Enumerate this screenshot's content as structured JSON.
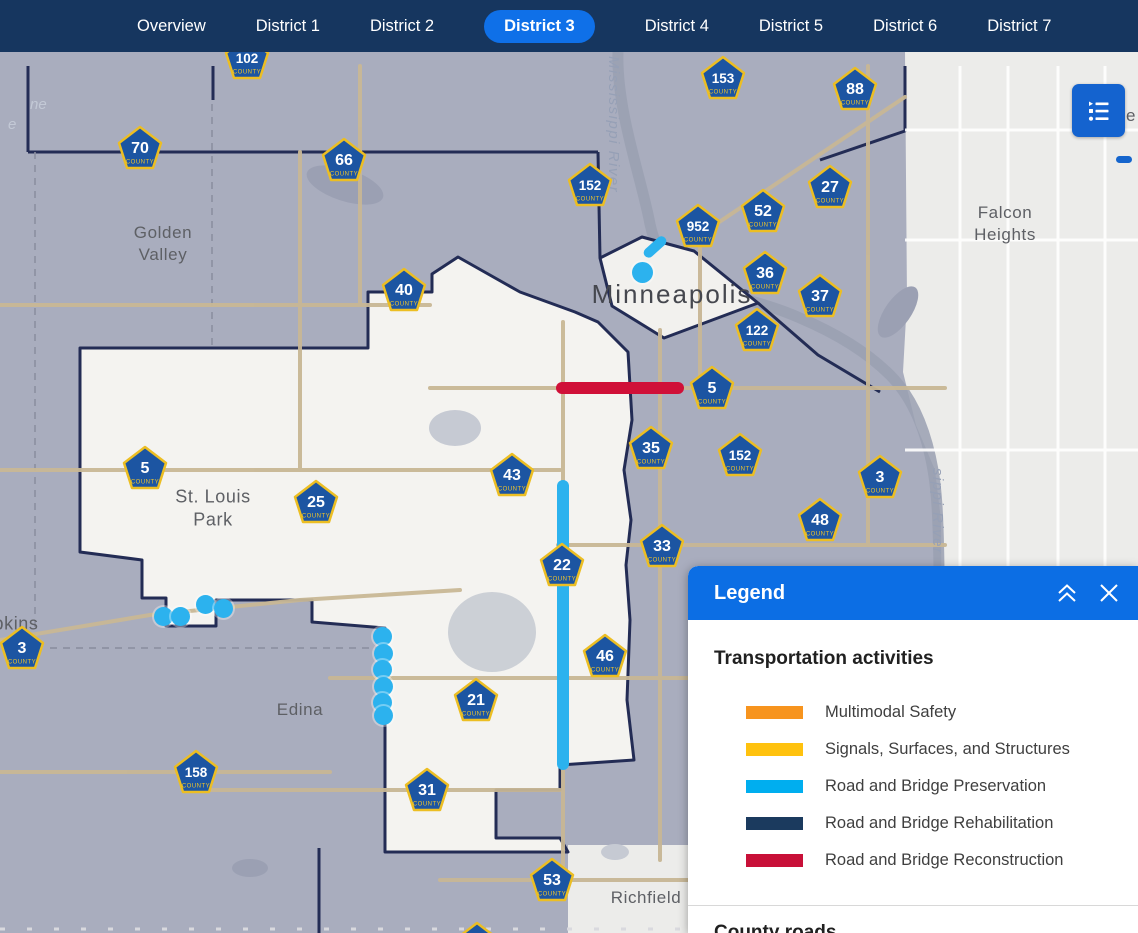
{
  "nav": {
    "tabs": [
      {
        "label": "Overview",
        "active": false
      },
      {
        "label": "District 1",
        "active": false
      },
      {
        "label": "District 2",
        "active": false
      },
      {
        "label": "District 3",
        "active": true
      },
      {
        "label": "District 4",
        "active": false
      },
      {
        "label": "District 5",
        "active": false
      },
      {
        "label": "District 6",
        "active": false
      },
      {
        "label": "District 7",
        "active": false
      }
    ]
  },
  "map": {
    "city_labels": [
      {
        "lines": [
          "Golden",
          "Valley"
        ],
        "x": 163,
        "y": 244,
        "size": 17
      },
      {
        "lines": [
          "Minneapolis"
        ],
        "x": 672,
        "y": 295,
        "size": 26,
        "big": true
      },
      {
        "lines": [
          "Falcon",
          "Heights"
        ],
        "x": 1005,
        "y": 224,
        "size": 17
      },
      {
        "lines": [
          "St. Louis",
          "Park"
        ],
        "x": 213,
        "y": 509,
        "size": 18
      },
      {
        "lines": [
          "pkins"
        ],
        "x": 16,
        "y": 624,
        "size": 18
      },
      {
        "lines": [
          "Edina"
        ],
        "x": 300,
        "y": 710,
        "size": 17
      },
      {
        "lines": [
          "Richfield"
        ],
        "x": 646,
        "y": 898,
        "size": 17
      }
    ],
    "water_labels": [
      {
        "text": "Mississippi River",
        "x": 622,
        "y": 56
      },
      {
        "text": "sippi River",
        "x": 946,
        "y": 468
      }
    ],
    "label_fragments": [
      {
        "text": "ne",
        "x": 30,
        "y": 96,
        "dark": false,
        "size": 15
      },
      {
        "text": "e",
        "x": 8,
        "y": 116,
        "dark": false,
        "size": 15
      },
      {
        "text": "e",
        "x": 1126,
        "y": 106,
        "dark": true,
        "size": 17
      }
    ],
    "shield_sub_label": "COUNTY",
    "shields": [
      {
        "n": "102",
        "x": 247,
        "y": 58
      },
      {
        "n": "70",
        "x": 140,
        "y": 148
      },
      {
        "n": "66",
        "x": 344,
        "y": 160
      },
      {
        "n": "153",
        "x": 723,
        "y": 78
      },
      {
        "n": "88",
        "x": 855,
        "y": 89
      },
      {
        "n": "152",
        "x": 590,
        "y": 185
      },
      {
        "n": "27",
        "x": 830,
        "y": 187
      },
      {
        "n": "52",
        "x": 763,
        "y": 211
      },
      {
        "n": "952",
        "x": 698,
        "y": 226
      },
      {
        "n": "36",
        "x": 765,
        "y": 273
      },
      {
        "n": "40",
        "x": 404,
        "y": 290
      },
      {
        "n": "37",
        "x": 820,
        "y": 296
      },
      {
        "n": "122",
        "x": 757,
        "y": 330
      },
      {
        "n": "5",
        "x": 712,
        "y": 388
      },
      {
        "n": "35",
        "x": 651,
        "y": 448
      },
      {
        "n": "152",
        "x": 740,
        "y": 455
      },
      {
        "n": "5",
        "x": 145,
        "y": 468
      },
      {
        "n": "43",
        "x": 512,
        "y": 475
      },
      {
        "n": "3",
        "x": 880,
        "y": 477
      },
      {
        "n": "25",
        "x": 316,
        "y": 502
      },
      {
        "n": "48",
        "x": 820,
        "y": 520
      },
      {
        "n": "33",
        "x": 662,
        "y": 546
      },
      {
        "n": "22",
        "x": 562,
        "y": 565
      },
      {
        "n": "3",
        "x": 22,
        "y": 648
      },
      {
        "n": "46",
        "x": 605,
        "y": 656
      },
      {
        "n": "21",
        "x": 476,
        "y": 700
      },
      {
        "n": "158",
        "x": 196,
        "y": 772
      },
      {
        "n": "31",
        "x": 427,
        "y": 790
      },
      {
        "n": "53",
        "x": 552,
        "y": 880
      },
      {
        "n": "",
        "x": 477,
        "y": 944
      }
    ],
    "features": {
      "preservation_color": "#2CB2EE",
      "reconstruction_color": "#D01038",
      "red_line": {
        "x": 556,
        "y": 382,
        "w": 128,
        "h": 12
      },
      "blue_line": {
        "x": 557,
        "y": 480,
        "w": 12,
        "h": 290
      },
      "downtown_segment": {
        "x": 645,
        "y": 251,
        "w": 27,
        "h": 10,
        "angle": -42
      },
      "downtown_dot": {
        "x": 642,
        "y": 272,
        "d": 21
      },
      "left_dots": [
        {
          "x": 163,
          "y": 616
        },
        {
          "x": 180,
          "y": 616
        },
        {
          "x": 205,
          "y": 604
        },
        {
          "x": 223,
          "y": 608
        }
      ],
      "edina_dots": [
        {
          "x": 382,
          "y": 636
        },
        {
          "x": 383,
          "y": 653
        },
        {
          "x": 382,
          "y": 669
        },
        {
          "x": 383,
          "y": 686
        },
        {
          "x": 382,
          "y": 702
        },
        {
          "x": 383,
          "y": 715
        }
      ]
    }
  },
  "legend_button": {
    "tooltip": "Legend"
  },
  "legend": {
    "title": "Legend",
    "section1": "Transportation activities",
    "activities": [
      {
        "color": "#F7941E",
        "label": "Multimodal Safety"
      },
      {
        "color": "#FFC20E",
        "label": "Signals, Surfaces, and Structures"
      },
      {
        "color": "#00AEEF",
        "label": "Road and Bridge Preservation"
      },
      {
        "color": "#1B3A5E",
        "label": "Road and Bridge Rehabilitation"
      },
      {
        "color": "#C81038",
        "label": "Road and Bridge Reconstruction"
      }
    ],
    "section2": "County roads"
  },
  "colors": {
    "nav_bg": "#16365F",
    "active_tab": "#0F70E8",
    "map_base": "#A9ADBE",
    "district_white": "#F4F3F0",
    "east_light": "#ECECEA",
    "boundary_navy": "#232C55",
    "road_tan": "#C8B795",
    "shield_fill": "#1C55A2",
    "shield_border": "#ECBE23",
    "legend_header": "#0C6EE4",
    "legend_button": "#1463CF"
  }
}
